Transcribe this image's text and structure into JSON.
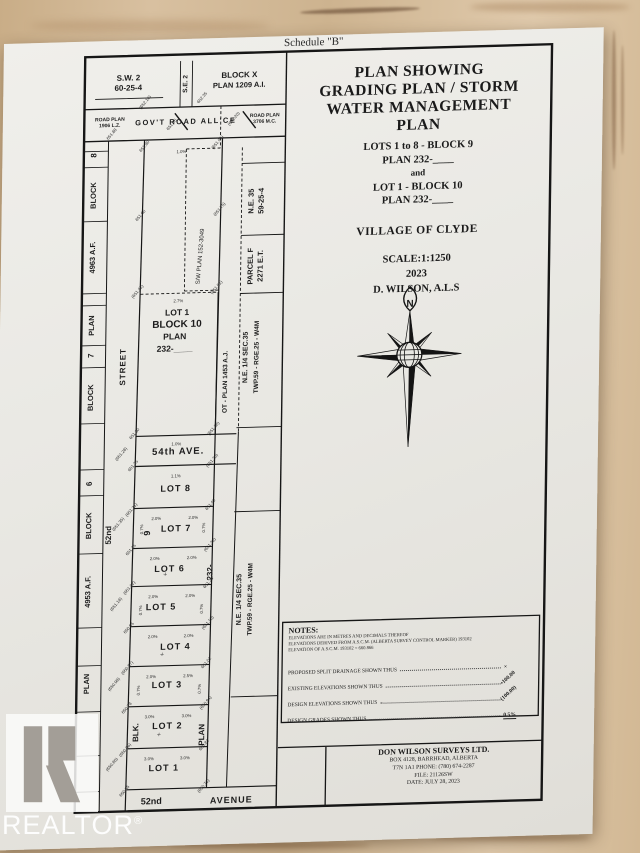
{
  "schedule_label": "Schedule \"B\"",
  "watermark": {
    "logo_letter": "R",
    "text": "REALTOR",
    "registered": "®"
  },
  "title_block": {
    "heading_lines": [
      "PLAN SHOWING",
      "GRADING PLAN / STORM",
      "WATER MANAGEMENT",
      "PLAN"
    ],
    "sub_lines": [
      "LOTS 1 to 8 - BLOCK 9",
      "PLAN 232-____",
      "and",
      "LOT 1 - BLOCK 10",
      "PLAN 232-____"
    ],
    "municipality": "VILLAGE OF CLYDE",
    "scale_lines": [
      "SCALE:1:1250",
      "2023",
      "D. WILSON, A.L.S"
    ],
    "compass_north": "N"
  },
  "notes": {
    "heading": "NOTES:",
    "lines": [
      "ELEVATIONS ARE IN METRES AND DECIMALS THEREOF",
      "ELEVATIONS DERIVED FROM A.S.C.M. (ALBERTA SURVEY CONTROL MARKER) 193102",
      "ELEVATION OF A.S.C.M. 193102 = 660.866"
    ],
    "legend": [
      {
        "label": "PROPOSED SPLIT DRAINAGE SHOWN THUS",
        "symbol": "×",
        "rot": 0,
        "underline": false
      },
      {
        "label": "EXISTING ELEVATIONS SHOWN THUS",
        "symbol": "•100.00",
        "rot": -42,
        "underline": false
      },
      {
        "label": "DESIGN ELEVATIONS SHOWN THUS",
        "symbol": "(100.00)",
        "rot": -42,
        "underline": false
      },
      {
        "label": "DESIGN GRADES SHOWN THUS",
        "symbol": "0.5%",
        "rot": 0,
        "underline": true
      }
    ]
  },
  "surveyor_box": {
    "name": "DON WILSON SURVEYS LTD.",
    "lines": [
      "BOX 4128, BARRHEAD, ALBERTA",
      "T7N 1A1 PHONE: (780) 674-2287",
      "FILE: 21126SW",
      "DATE: JULY 28, 2023"
    ]
  },
  "plat": {
    "labels": [
      {
        "t": "S.W. 2",
        "x": 45,
        "y": 26,
        "fs": 8,
        "b": 1
      },
      {
        "t": "60-25-4",
        "x": 45,
        "y": 36,
        "fs": 8,
        "b": 1
      },
      {
        "t": "S.E. 2",
        "x": 104,
        "y": 31,
        "fs": 6.5,
        "r": -90,
        "b": 1
      },
      {
        "t": "BLOCK X",
        "x": 156,
        "y": 26,
        "fs": 8,
        "b": 1
      },
      {
        "t": "PLAN 1209 A.I.",
        "x": 156,
        "y": 36,
        "fs": 7.5,
        "b": 1
      },
      {
        "t": "ROAD PLAN",
        "x": 27,
        "y": 66,
        "fs": 5,
        "b": 1
      },
      {
        "t": "1906 L.Z.",
        "x": 27,
        "y": 72,
        "fs": 5,
        "b": 1
      },
      {
        "t": "GOV'T   ROAD   ALL'CE",
        "x": 103,
        "y": 71,
        "fs": 7.5,
        "b": 1,
        "ls": 1.5
      },
      {
        "t": "ROAD PLAN",
        "x": 182,
        "y": 66,
        "fs": 5,
        "b": 1
      },
      {
        "t": "3706 M.C.",
        "x": 182,
        "y": 72,
        "fs": 5,
        "b": 1
      },
      {
        "t": "8",
        "x": 14,
        "y": 100,
        "fs": 8,
        "r": -90,
        "b": 1
      },
      {
        "t": "BLOCK",
        "x": 14,
        "y": 140,
        "fs": 7.5,
        "r": -90,
        "b": 1
      },
      {
        "t": "4963 A.F.",
        "x": 14,
        "y": 202,
        "fs": 7.5,
        "r": -90,
        "b": 1
      },
      {
        "t": "PLAN",
        "x": 14,
        "y": 270,
        "fs": 7.5,
        "r": -90,
        "b": 1
      },
      {
        "t": "7",
        "x": 14,
        "y": 300,
        "fs": 8,
        "r": -90,
        "b": 1
      },
      {
        "t": "BLOCK",
        "x": 14,
        "y": 342,
        "fs": 7.5,
        "r": -90,
        "b": 1
      },
      {
        "t": "6",
        "x": 14,
        "y": 428,
        "fs": 8,
        "r": -90,
        "b": 1
      },
      {
        "t": "BLOCK",
        "x": 14,
        "y": 470,
        "fs": 7.5,
        "r": -90,
        "b": 1
      },
      {
        "t": "4953 A.F.",
        "x": 14,
        "y": 536,
        "fs": 7.5,
        "r": -90,
        "b": 1
      },
      {
        "t": "PLAN",
        "x": 14,
        "y": 628,
        "fs": 7.5,
        "r": -90,
        "b": 1
      },
      {
        "t": "STREET",
        "x": 46,
        "y": 312,
        "fs": 8,
        "r": -90,
        "b": 1,
        "ls": 1
      },
      {
        "t": "52nd",
        "x": 34,
        "y": 480,
        "fs": 8,
        "r": -90,
        "b": 1
      },
      {
        "t": "LOT 1",
        "x": 97,
        "y": 262,
        "fs": 8.5,
        "b": 1
      },
      {
        "t": "BLOCK 10",
        "x": 97,
        "y": 274,
        "fs": 10,
        "b": 1
      },
      {
        "t": "PLAN",
        "x": 95,
        "y": 286,
        "fs": 8.5,
        "b": 1
      },
      {
        "t": "232-____",
        "x": 95,
        "y": 298,
        "fs": 8.5,
        "b": 1
      },
      {
        "t": "S/W PLAN 152-3049",
        "x": 121,
        "y": 204,
        "fs": 6,
        "r": -86
      },
      {
        "t": "OT - PLAN 1453 A.J.",
        "x": 148,
        "y": 330,
        "fs": 6.5,
        "r": -90,
        "b": 1
      },
      {
        "t": "N.E. 35",
        "x": 172,
        "y": 150,
        "fs": 7.5,
        "r": -90,
        "b": 1
      },
      {
        "t": "59-25-4",
        "x": 182,
        "y": 150,
        "fs": 7.5,
        "r": -90,
        "b": 1
      },
      {
        "t": "PARCEL F",
        "x": 172,
        "y": 215,
        "fs": 7.5,
        "r": -90,
        "b": 1
      },
      {
        "t": "2271 E.T.",
        "x": 182,
        "y": 215,
        "fs": 7.5,
        "r": -90,
        "b": 1
      },
      {
        "t": "N.E. 1/4 SEC.35",
        "x": 168,
        "y": 306,
        "fs": 7,
        "r": -90,
        "b": 1
      },
      {
        "t": "TWP.59 - RGE.25 - W4M",
        "x": 179,
        "y": 306,
        "fs": 6.5,
        "r": -90,
        "b": 1
      },
      {
        "t": "N.E. 1/4 SEC.35",
        "x": 165,
        "y": 548,
        "fs": 7,
        "r": -90,
        "b": 1
      },
      {
        "t": "TWP.59 - RGE.25 - W4M",
        "x": 176,
        "y": 548,
        "fs": 6.5,
        "r": -90,
        "b": 1
      },
      {
        "t": "54th  AVE.",
        "x": 100,
        "y": 401,
        "fs": 9.5,
        "b": 1,
        "ls": 1
      },
      {
        "t": "LOT 8",
        "x": 98,
        "y": 438,
        "fs": 9,
        "b": 1,
        "ls": 1
      },
      {
        "t": "9",
        "x": 73,
        "y": 479,
        "fs": 9,
        "r": -90,
        "b": 1
      },
      {
        "t": "LOT 7",
        "x": 99,
        "y": 478,
        "fs": 9,
        "b": 1,
        "ls": 1
      },
      {
        "t": "LOT 6",
        "x": 93,
        "y": 518,
        "fs": 9,
        "b": 1,
        "ls": 1
      },
      {
        "t": "232-",
        "x": 136,
        "y": 520,
        "fs": 8,
        "r": -90,
        "b": 1
      },
      {
        "t": "LOT 5",
        "x": 85,
        "y": 556,
        "fs": 9,
        "b": 1,
        "ls": 1
      },
      {
        "t": "LOT 4",
        "x": 100,
        "y": 596,
        "fs": 9,
        "b": 1,
        "ls": 1
      },
      {
        "t": "LOT 3",
        "x": 92,
        "y": 634,
        "fs": 9,
        "b": 1,
        "ls": 1
      },
      {
        "t": "LOT 2",
        "x": 93,
        "y": 675,
        "fs": 9,
        "b": 1,
        "ls": 1
      },
      {
        "t": "BLK.",
        "x": 64,
        "y": 678,
        "fs": 8,
        "r": -90,
        "b": 1
      },
      {
        "t": "PLAN",
        "x": 130,
        "y": 682,
        "fs": 8,
        "r": -90,
        "b": 1
      },
      {
        "t": "LOT 1",
        "x": 90,
        "y": 717,
        "fs": 9,
        "b": 1,
        "ls": 1
      },
      {
        "t": "52nd",
        "x": 78,
        "y": 750,
        "fs": 9,
        "b": 1
      },
      {
        "t": "AVENUE",
        "x": 158,
        "y": 751,
        "fs": 9,
        "b": 1,
        "ls": 1
      }
    ],
    "micro": [
      {
        "t": "(652.10)",
        "x": 63,
        "y": 49
      },
      {
        "t": "652.35",
        "x": 120,
        "y": 46
      },
      {
        "t": "(652.20)",
        "x": 152,
        "y": 68
      },
      {
        "t": "651.95",
        "x": 90,
        "y": 72
      },
      {
        "t": "651.80",
        "x": 63,
        "y": 93
      },
      {
        "t": "(651.95)",
        "x": 136,
        "y": 91
      },
      {
        "t": "1.0%",
        "x": 99,
        "y": 100,
        "r": 0
      },
      {
        "t": "651.60",
        "x": 60,
        "y": 162
      },
      {
        "t": "(651.75)",
        "x": 139,
        "y": 158
      },
      {
        "t": "2.7%",
        "x": 98,
        "y": 249,
        "r": 0
      },
      {
        "t": "(651.42)",
        "x": 58,
        "y": 238
      },
      {
        "t": "(651.52)",
        "x": 137,
        "y": 236
      },
      {
        "t": "651.30",
        "x": 57,
        "y": 380
      },
      {
        "t": "(651.38)",
        "x": 136,
        "y": 377
      },
      {
        "t": "1.0%",
        "x": 98,
        "y": 392,
        "r": 0
      },
      {
        "t": "651.25",
        "x": 56,
        "y": 412
      },
      {
        "t": "(651.30)",
        "x": 135,
        "y": 409
      },
      {
        "t": "1.1%",
        "x": 98,
        "y": 424,
        "r": 0
      },
      {
        "t": "(651.21)",
        "x": 55,
        "y": 456
      },
      {
        "t": "651.40",
        "x": 134,
        "y": 453
      },
      {
        "t": "2.0%",
        "x": 79,
        "y": 466,
        "r": 0
      },
      {
        "t": "2.0%",
        "x": 116,
        "y": 466,
        "r": 0
      },
      {
        "t": "651.15",
        "x": 55,
        "y": 496
      },
      {
        "t": "(651.32)",
        "x": 134,
        "y": 493
      },
      {
        "t": "2.0%",
        "x": 78,
        "y": 506,
        "r": 0
      },
      {
        "t": "2.0%",
        "x": 115,
        "y": 506,
        "r": 0
      },
      {
        "t": "(651.02)",
        "x": 54,
        "y": 534
      },
      {
        "t": "651.24",
        "x": 133,
        "y": 531
      },
      {
        "t": "2.0%",
        "x": 77,
        "y": 544,
        "r": 0
      },
      {
        "t": "2.0%",
        "x": 114,
        "y": 544,
        "r": 0
      },
      {
        "t": "650.95",
        "x": 54,
        "y": 574
      },
      {
        "t": "(651.10)",
        "x": 133,
        "y": 571
      },
      {
        "t": "2.0%",
        "x": 77,
        "y": 584,
        "r": 0
      },
      {
        "t": "2.0%",
        "x": 113,
        "y": 584,
        "r": 0
      },
      {
        "t": "(650.87)",
        "x": 53,
        "y": 614
      },
      {
        "t": "651.02",
        "x": 132,
        "y": 611
      },
      {
        "t": "2.0%",
        "x": 76,
        "y": 624,
        "r": 0
      },
      {
        "t": "2.5%",
        "x": 113,
        "y": 624,
        "r": 0
      },
      {
        "t": "650.78",
        "x": 53,
        "y": 654
      },
      {
        "t": "(650.94)",
        "x": 132,
        "y": 651
      },
      {
        "t": "3.0%",
        "x": 75,
        "y": 664,
        "r": 0
      },
      {
        "t": "3.0%",
        "x": 112,
        "y": 664,
        "r": 0
      },
      {
        "t": "(650.66)",
        "x": 52,
        "y": 696
      },
      {
        "t": "650.82",
        "x": 131,
        "y": 693
      },
      {
        "t": "3.0%",
        "x": 75,
        "y": 706,
        "r": 0
      },
      {
        "t": "3.0%",
        "x": 111,
        "y": 706,
        "r": 0
      },
      {
        "t": "650.55",
        "x": 52,
        "y": 737
      },
      {
        "t": "(650.71)",
        "x": 131,
        "y": 734
      },
      {
        "t": "(651.35)",
        "x": 42,
        "y": 470
      },
      {
        "t": "(651.18)",
        "x": 41,
        "y": 550
      },
      {
        "t": "(650.98)",
        "x": 40,
        "y": 630
      },
      {
        "t": "(650.80)",
        "x": 39,
        "y": 710
      },
      {
        "t": "(651.28)",
        "x": 44,
        "y": 400
      },
      {
        "t": "651.88",
        "x": 30,
        "y": 80
      },
      {
        "t": "0.7%",
        "x": 66,
        "y": 475,
        "r": -90
      },
      {
        "t": "0.7%",
        "x": 66,
        "y": 556,
        "r": -90
      },
      {
        "t": "0.7%",
        "x": 65,
        "y": 636,
        "r": -90
      },
      {
        "t": "0.7%",
        "x": 128,
        "y": 475,
        "r": -90
      },
      {
        "t": "0.7%",
        "x": 127,
        "y": 556,
        "r": -90
      },
      {
        "t": "0.7%",
        "x": 126,
        "y": 636,
        "r": -90
      },
      {
        "t": "×",
        "x": 90,
        "y": 522,
        "r": -40,
        "fs": 6
      },
      {
        "t": "×",
        "x": 88,
        "y": 602,
        "r": -40,
        "fs": 6
      },
      {
        "t": "×",
        "x": 86,
        "y": 682,
        "r": -40,
        "fs": 6
      }
    ]
  }
}
